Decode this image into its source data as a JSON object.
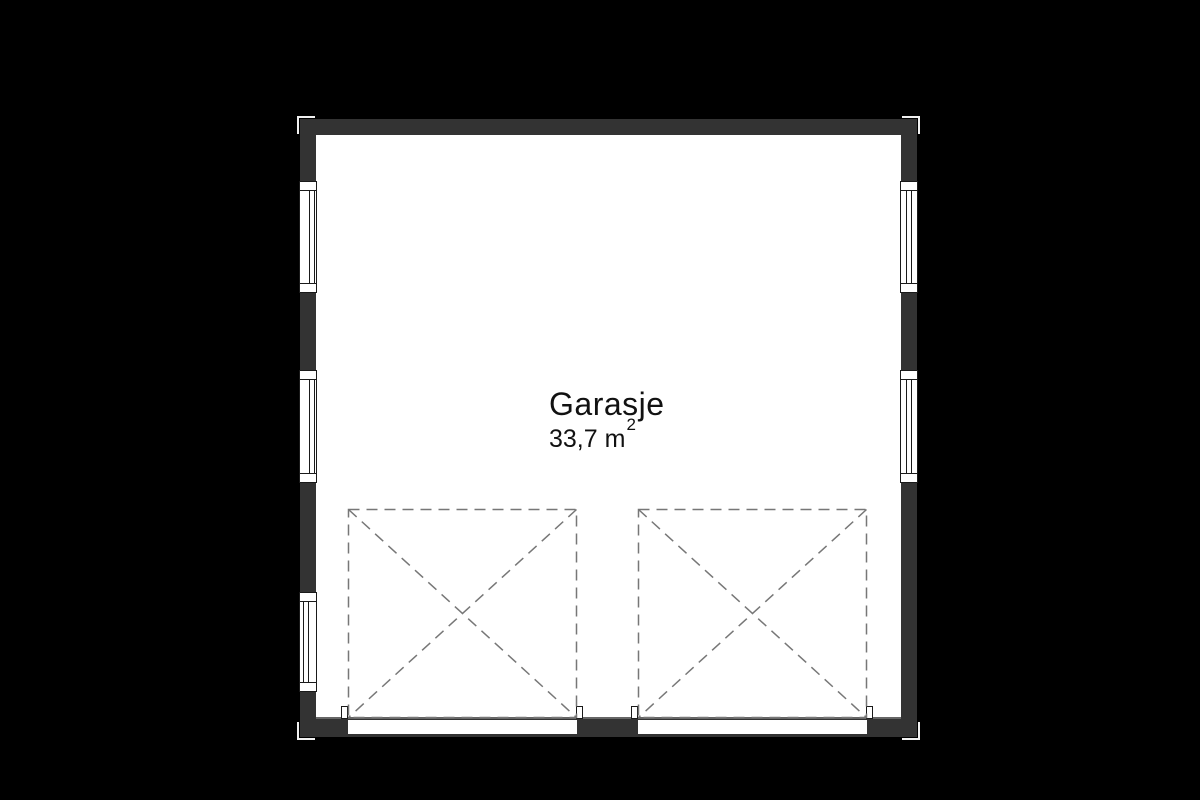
{
  "plan": {
    "room_label": "Garasje",
    "area_value": "33,7 m",
    "area_superscript": "2",
    "colors": {
      "background": "#000000",
      "wall": "#333333",
      "interior": "#ffffff",
      "outline": "#1a1a1a",
      "dash": "#777777",
      "threshold": "#666666",
      "corner_mark": "#f0f0f0",
      "text": "#111111"
    }
  }
}
